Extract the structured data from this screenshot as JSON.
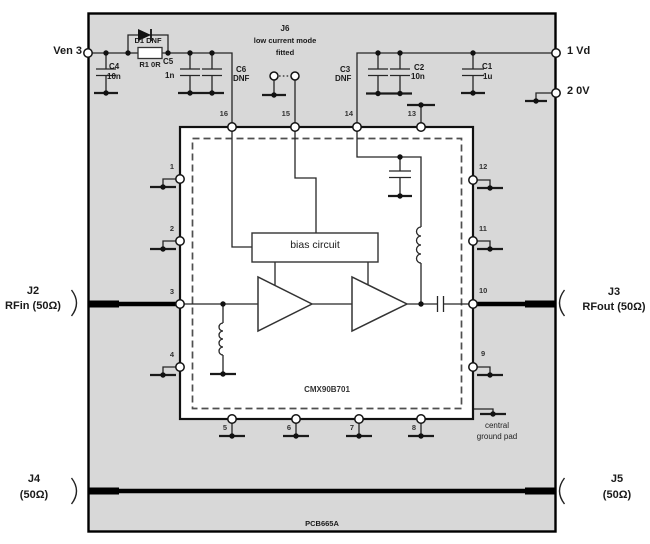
{
  "board": {
    "pcb_ref": "PCB665A",
    "chip_name": "CMX90B701",
    "bias_block": "bias circuit",
    "central_ground_line1": "central",
    "central_ground_line2": "ground pad"
  },
  "terminals": {
    "ven": "Ven 3",
    "vd": "1 Vd",
    "zero_v": "2 0V"
  },
  "connectors": {
    "j2_name": "J2",
    "j2_desc": "RFin (50Ω)",
    "j3_name": "J3",
    "j3_desc": "RFout (50Ω)",
    "j4_name": "J4",
    "j4_desc": "(50Ω)",
    "j5_name": "J5",
    "j5_desc": "(50Ω)",
    "j6_name": "J6",
    "j6_desc": "low current mode",
    "j6_state": "fitted"
  },
  "components": {
    "d1": "D1 DNF",
    "r1": "R1 0R",
    "c1_ref": "C1",
    "c1_val": "1u",
    "c2_ref": "C2",
    "c2_val": "10n",
    "c3_ref": "C3",
    "c3_val": "DNF",
    "c4_ref": "C4",
    "c4_val": "10n",
    "c5_ref": "C5",
    "c5_val": "1n",
    "c6_ref": "C6",
    "c6_val": "DNF"
  },
  "pins": {
    "p1": "1",
    "p2": "2",
    "p3": "3",
    "p4": "4",
    "p5": "5",
    "p6": "6",
    "p7": "7",
    "p8": "8",
    "p9": "9",
    "p10": "10",
    "p11": "11",
    "p12": "12",
    "p13": "13",
    "p14": "14",
    "p15": "15",
    "p16": "16"
  },
  "colors": {
    "board_fill": "#d8d8d8",
    "wire": "#262626",
    "text": "#1a1a1a"
  }
}
